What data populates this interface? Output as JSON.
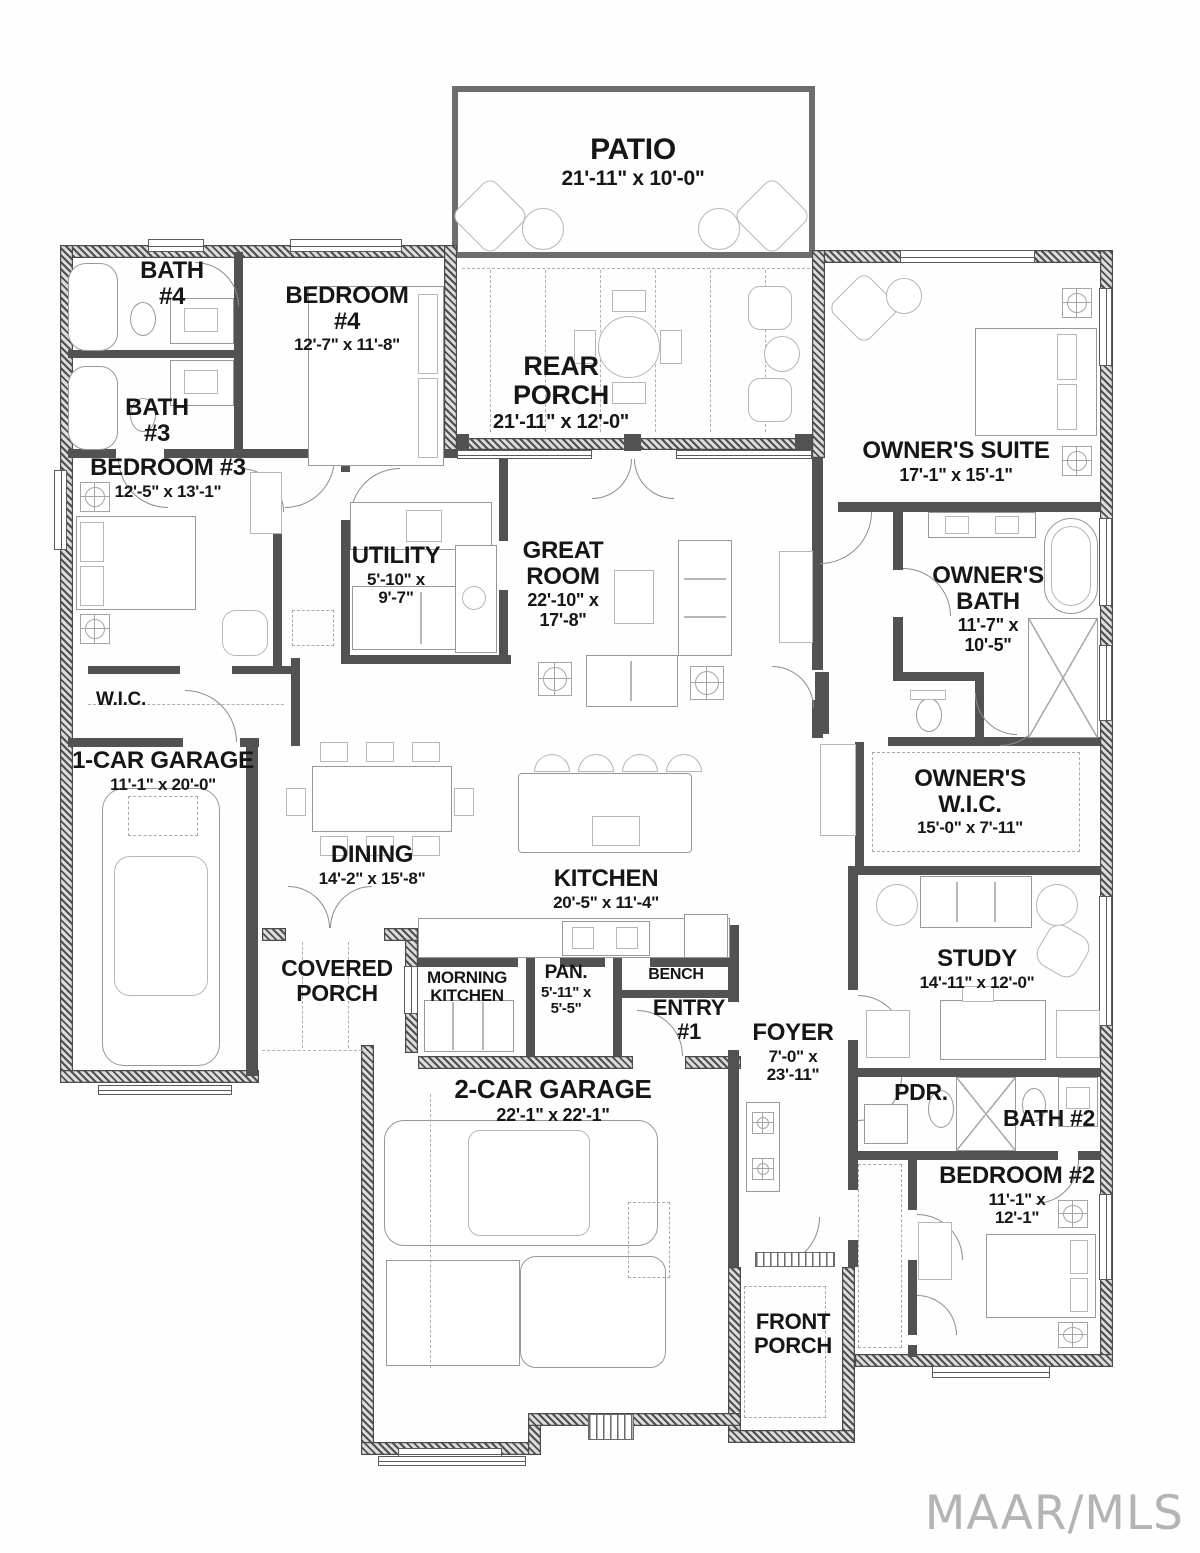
{
  "watermark": "MAAR/MLS",
  "colors": {
    "wall": "#4f4f4f",
    "exterior_hatch": "#4a4a4a",
    "furniture_outline": "#989898",
    "label_text": "#161616",
    "watermark_gray": "#b6b3b3"
  },
  "rooms": {
    "patio": {
      "name": "PATIO",
      "dims": "21'-11\" x 10'-0\""
    },
    "rear_porch": {
      "name": "REAR PORCH",
      "dims": "21'-11\" x 12'-0\""
    },
    "bath4": {
      "name": "BATH #4"
    },
    "bedroom4": {
      "name": "BEDROOM #4",
      "dims": "12'-7\" x 11'-8\""
    },
    "bath3": {
      "name": "BATH #3"
    },
    "bedroom3": {
      "name": "BEDROOM #3",
      "dims": "12'-5\" x 13'-1\""
    },
    "owners_suite": {
      "name": "OWNER'S SUITE",
      "dims": "17'-1\" x 15'-1\""
    },
    "utility": {
      "name": "UTILITY",
      "dims": "5'-10\" x 9'-7\""
    },
    "great_room": {
      "name": "GREAT ROOM",
      "dims": "22'-10\" x 17'-8\""
    },
    "owners_bath": {
      "name": "OWNER'S BATH",
      "dims": "11'-7\" x 10'-5\""
    },
    "wic": {
      "name": "W.I.C."
    },
    "garage1": {
      "name": "1-CAR GARAGE",
      "dims": "11'-1\" x 20'-0\""
    },
    "owners_wic": {
      "name": "OWNER'S W.I.C.",
      "dims": "15'-0\" x 7'-11\""
    },
    "dining": {
      "name": "DINING",
      "dims": "14'-2\" x 15'-8\""
    },
    "kitchen": {
      "name": "KITCHEN",
      "dims": "20'-5\" x 11'-4\""
    },
    "study": {
      "name": "STUDY",
      "dims": "14'-11\" x 12'-0\""
    },
    "covered_porch": {
      "name": "COVERED PORCH"
    },
    "morning_kitchen": {
      "name": "MORNING KITCHEN"
    },
    "pantry": {
      "name": "PAN.",
      "dims": "5'-11\" x 5'-5\""
    },
    "bench": {
      "name": "BENCH"
    },
    "entry1": {
      "name": "ENTRY #1"
    },
    "foyer": {
      "name": "FOYER",
      "dims": "7'-0\" x 23'-11\""
    },
    "pdr": {
      "name": "PDR."
    },
    "bath2": {
      "name": "BATH #2"
    },
    "bedroom2": {
      "name": "BEDROOM #2",
      "dims": "11'-1\" x 12'-1\""
    },
    "garage2": {
      "name": "2-CAR GARAGE",
      "dims": "22'-1\" x 22'-1\""
    },
    "front_porch": {
      "name": "FRONT PORCH"
    }
  }
}
